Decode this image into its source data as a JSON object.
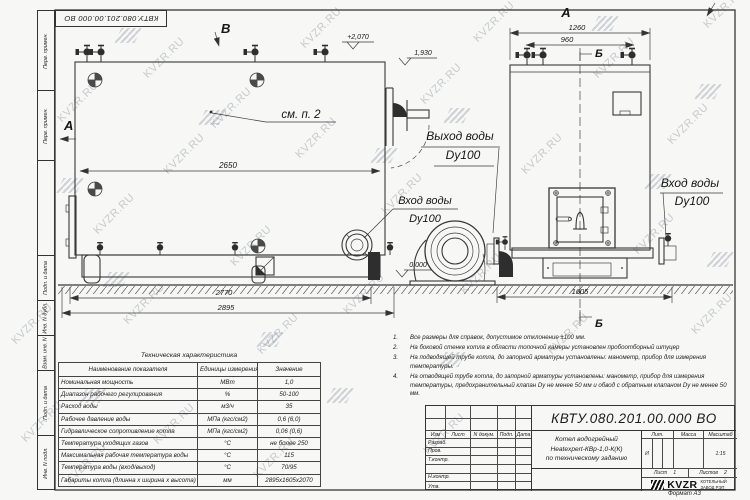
{
  "page": {
    "watermark": "KVZR.RU",
    "stamp_number": "КВТУ.080.201.00.000  ВО",
    "format_label": "Формат  А3"
  },
  "frame": {
    "side_labels": [
      "Перв. примен.",
      "Перв. примен.",
      "",
      "Подп. и дата",
      "Инв. N дубл.",
      "Взам. инв. N",
      "Подп. и дата",
      "Инв. N подл."
    ]
  },
  "drawing": {
    "marks": {
      "view_a": "А",
      "view_b": "В",
      "view_a2": "А",
      "sec_b_top": "Б",
      "sec_b_bottom": "Б",
      "see_note": "см. п. 2",
      "elev_top": "+2,070",
      "elev_mid": "1,930",
      "elev_zero": "0.000"
    },
    "dims": {
      "d2650": "2650",
      "d2770": "2770",
      "d2895": "2895",
      "d1260": "1260",
      "d960": "960",
      "d1605": "1605"
    },
    "labels": {
      "inlet_left_1": "Вход воды",
      "inlet_left_2": "Dy100",
      "outlet_1": "Выход воды",
      "outlet_2": "Dy100",
      "inlet_right_1": "Вход воды",
      "inlet_right_2": "Dy100"
    }
  },
  "notes": {
    "items": [
      {
        "n": "1.",
        "t": "Все размеры для справок, допустимое отклонение  ±100 мм."
      },
      {
        "n": "2.",
        "t": "На боковой стенке котла в области топочной камеры установлен пробоотборный штуцер"
      },
      {
        "n": "3.",
        "t": "На  подводящей трубе котла, до запорной арматуры установлены: манометр, прибор для измерения температуры."
      },
      {
        "n": "4.",
        "t": "На отводящей трубе котла, до запорной арматуры установлены: манометр, прибор для измерения температуры, предохранительный клапан  Dу не менее  50 мм и обвод с обратным клапаном  Dу не менее  50 мм."
      }
    ]
  },
  "tech_table": {
    "title": "Техническая характеристика",
    "headers": [
      "Наименование показателя",
      "Единицы измерения",
      "Значение"
    ],
    "rows": [
      [
        "Номинальная мощность",
        "МВт",
        "1,0"
      ],
      [
        "Диапазон рабочего регулирования",
        "%",
        "50-100"
      ],
      [
        "Расход воды",
        "м3/ч",
        "35"
      ],
      [
        "Рабочее давление воды",
        "МПа (кгс/см2)",
        "0,6 (6,0)"
      ],
      [
        "Гидравлическое сопротивление котла",
        "МПа (кгс/см2)",
        "0,06 (0,6)"
      ],
      [
        "Температура уходящих газов",
        "°С",
        "не более 250"
      ],
      [
        "Максимальная рабочая температура воды",
        "°С",
        "115"
      ],
      [
        "Температура воды (вход/выход)",
        "°С",
        "70/95"
      ],
      [
        "Габариты котла (длинна х ширина х высота)",
        "мм",
        "2895х1605х2070"
      ]
    ]
  },
  "title_block": {
    "doc_number": "КВТУ.080.201.00.000  ВО",
    "rev_headers": {
      "izm": "Изм",
      "list": "Лист",
      "ndoc": "N докум.",
      "podp": "Подп.",
      "data": "Дата"
    },
    "sig_rows": [
      "Разраб.",
      "Пров.",
      "Т.контр.",
      "",
      "Н.контр.",
      "Утв."
    ],
    "title_line1": "Котел водогрейный",
    "title_line2": "Heatexpert-КВр-1,0-К(К)",
    "title_line3": "по техническому заданию",
    "lit_header": "Лит.",
    "mass_header": "Масса",
    "scale_header": "Масштаб",
    "lit_value": "И",
    "scale_value": "1:15",
    "sheet_label": "Лист",
    "sheet_value": "1",
    "sheets_label": "Листов",
    "sheets_value": "2",
    "company_logo": "KVZR",
    "company_line1": "КОТЕЛЬНЫЙ",
    "company_line2": "ЗАВОД РЭП"
  }
}
